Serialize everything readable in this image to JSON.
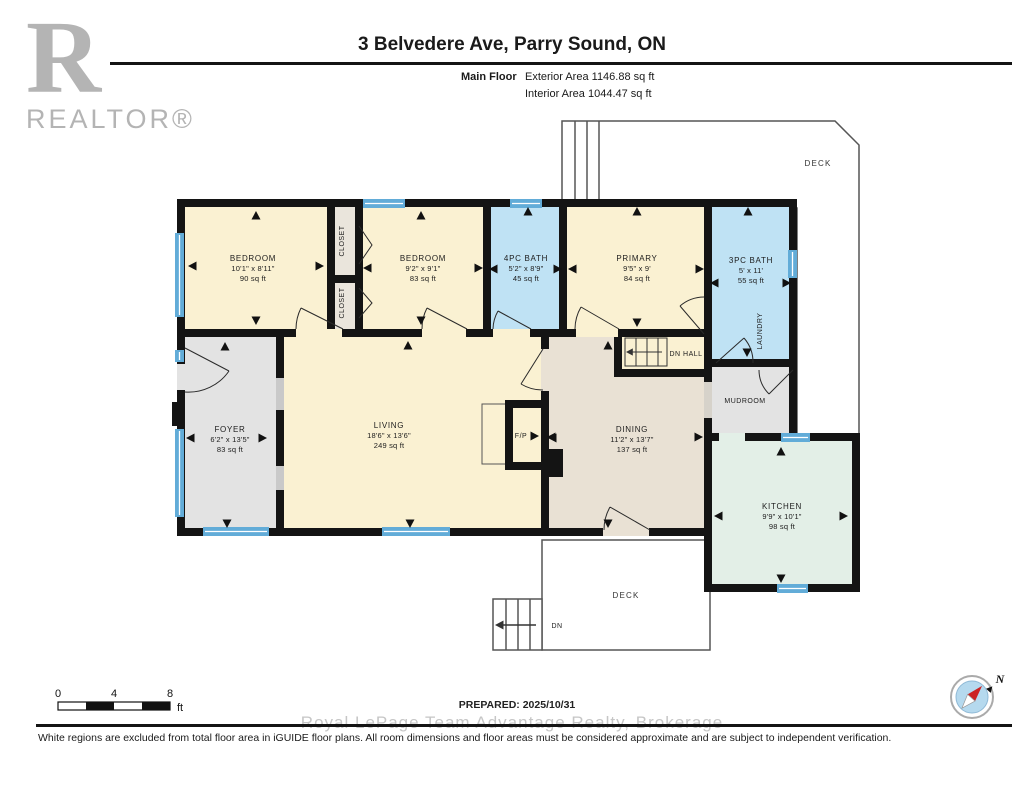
{
  "header": {
    "title": "3 Belvedere Ave, Parry Sound, ON",
    "floor_label": "Main Floor",
    "exterior_area": "Exterior Area 1146.88 sq ft",
    "interior_area": "Interior Area 1044.47 sq ft"
  },
  "logo": {
    "letter": "R",
    "wordmark": "REALTOR®"
  },
  "rooms": {
    "bedroom1": {
      "name": "BEDROOM",
      "dims": "10'1\" x 8'11\"",
      "area": "90 sq ft"
    },
    "closet_top": {
      "name": "CLOSET"
    },
    "closet_bottom": {
      "name": "CLOSET"
    },
    "bedroom2": {
      "name": "BEDROOM",
      "dims": "9'2\" x 9'1\"",
      "area": "83 sq ft"
    },
    "bath_4pc": {
      "name": "4PC BATH",
      "dims": "5'2\" x 8'9\"",
      "area": "45 sq ft"
    },
    "primary": {
      "name": "PRIMARY",
      "dims": "9'5\" x 9'",
      "area": "84 sq ft"
    },
    "bath_3pc": {
      "name": "3PC BATH",
      "dims": "5' x 11'",
      "area": "55 sq ft"
    },
    "laundry": {
      "name": "LAUNDRY"
    },
    "dn_hall": {
      "name": "DN HALL"
    },
    "mudroom": {
      "name": "MUDROOM"
    },
    "foyer": {
      "name": "FOYER",
      "dims": "6'2\" x 13'5\"",
      "area": "83 sq ft"
    },
    "living": {
      "name": "LIVING",
      "dims": "18'6\" x 13'6\"",
      "area": "249 sq ft"
    },
    "fireplace": {
      "name": "F/P"
    },
    "dining": {
      "name": "DINING",
      "dims": "11'2\" x 13'7\"",
      "area": "137 sq ft"
    },
    "kitchen": {
      "name": "KITCHEN",
      "dims": "9'9\" x 10'1\"",
      "area": "98 sq ft"
    },
    "deck_top": {
      "name": "DECK"
    },
    "deck_bottom": {
      "name": "DECK"
    },
    "stairs_down": {
      "label": "DN"
    }
  },
  "scale_bar": {
    "ticks": [
      "0",
      "4",
      "8"
    ],
    "unit": "ft"
  },
  "prepared_label": "PREPARED: 2025/10/31",
  "compass": {
    "north_label": "N"
  },
  "watermark": "Royal LePage Team Advantage Realty, Brokerage",
  "disclaimer": "White regions are excluded from total floor area in iGUIDE floor plans. All room dimensions and floor areas must be considered approximate and are subject to independent verification.",
  "colors": {
    "room_cream": "#FAF1D2",
    "room_blue": "#BFE2F4",
    "room_gray": "#E3E3E3",
    "room_tan": "#E9E1D4",
    "room_mint": "#E3EFE7",
    "closet": "#EAE5DC",
    "window": "#62ACD8",
    "wall": "#141414"
  }
}
